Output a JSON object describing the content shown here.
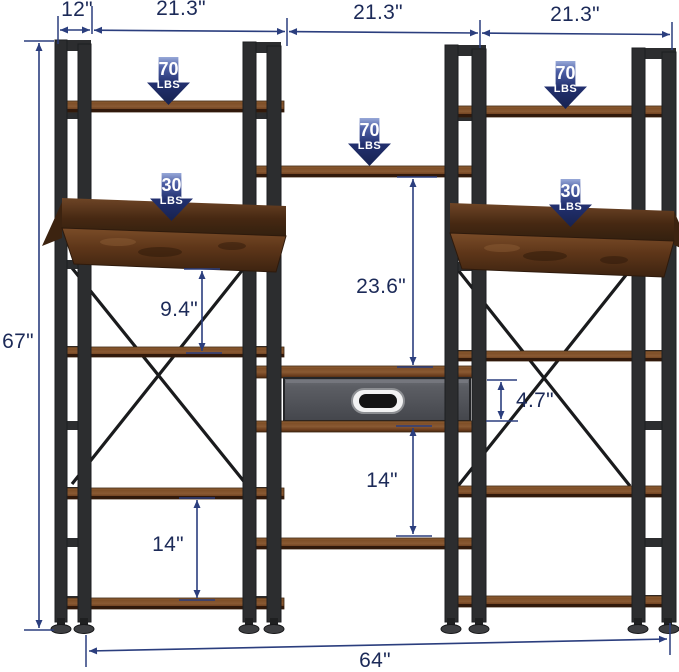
{
  "page": {
    "background": "#ffffff"
  },
  "product_diagram": {
    "dimensions": {
      "depth_top": "12\"",
      "width_left_section": "21.3\"",
      "width_center_section": "21.3\"",
      "width_right_section": "21.3\"",
      "overall_height": "67\"",
      "center_shelf_to_drawer_gap": "23.6\"",
      "left_bin_to_shelf_gap": "9.4\"",
      "drawer_front_height": "4.7\"",
      "center_drawer_to_shelf_gap": "14\"",
      "left_bottom_shelf_gap": "14\"",
      "overall_width": "64\""
    },
    "weight_badges": {
      "left_top_shelf": {
        "value": "70",
        "unit": "LBS"
      },
      "center_top_shelf": {
        "value": "70",
        "unit": "LBS"
      },
      "right_top_shelf": {
        "value": "70",
        "unit": "LBS"
      },
      "left_bin_shelf": {
        "value": "30",
        "unit": "LBS"
      },
      "right_bin_shelf": {
        "value": "30",
        "unit": "LBS"
      }
    },
    "colors": {
      "dimension_line": "#2b3e7e",
      "dimension_text": "#1c2a58",
      "badge_gradient_top": "#97a8d8",
      "badge_gradient_bottom": "#17224f",
      "frame_metal": "#2c2d2f",
      "wood_light": "#8a5a33",
      "wood_dark": "#4a2a12",
      "drawer_face": "#5c5e64"
    }
  }
}
